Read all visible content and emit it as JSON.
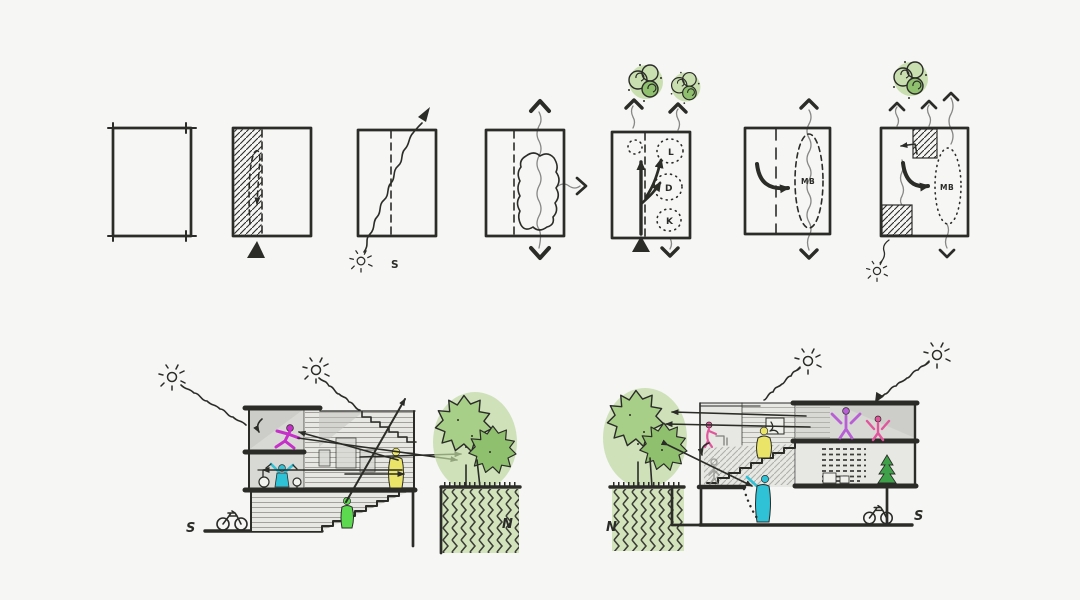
{
  "canvas": {
    "width": 1080,
    "height": 600,
    "background": "#f6f6f5",
    "ink": "#2b2b28"
  },
  "colors": {
    "tree_wash": "#bed99f",
    "tree_light": "#a8cf88",
    "tree_dark": "#8fc06e",
    "ground_wash": "#d3e4bc",
    "plant_green": "#3fa04a",
    "room_gray": "#d8d8d4",
    "shade_gray": "#c2c2be",
    "volume_gray": "#e7e7e3",
    "magenta": "#c62fc9",
    "cyan": "#2fc2d7",
    "yellow": "#eae468",
    "green": "#5cd94f",
    "purple": "#b85ed6",
    "pink": "#e2559c"
  },
  "top_row": {
    "name": "concept-plan-diagrams",
    "diagrams": [
      {
        "name": "site-outline",
        "labels": {}
      },
      {
        "name": "entry-strip",
        "labels": {}
      },
      {
        "name": "sun-path",
        "labels": {
          "south": "S"
        }
      },
      {
        "name": "courtyard-ventilation",
        "labels": {}
      },
      {
        "name": "program-ldk",
        "labels": {
          "living": "L",
          "dining": "D",
          "kitchen": "K"
        }
      },
      {
        "name": "master-bedroom",
        "labels": {
          "master_bedroom": "MB"
        }
      },
      {
        "name": "final-scheme",
        "labels": {
          "master_bedroom": "MB"
        }
      }
    ]
  },
  "sections": {
    "left": {
      "name": "section-south-to-north",
      "labels": {
        "south": "S",
        "north": "N"
      }
    },
    "right": {
      "name": "section-north-to-south",
      "labels": {
        "north": "N",
        "south": "S"
      }
    }
  },
  "icons": {
    "sun": "sun-icon",
    "tree": "tree-icon",
    "bubble_tree": "bubble-tree-icon",
    "bicycle": "bicycle-icon",
    "entry_marker": "entry-marker-icon"
  }
}
